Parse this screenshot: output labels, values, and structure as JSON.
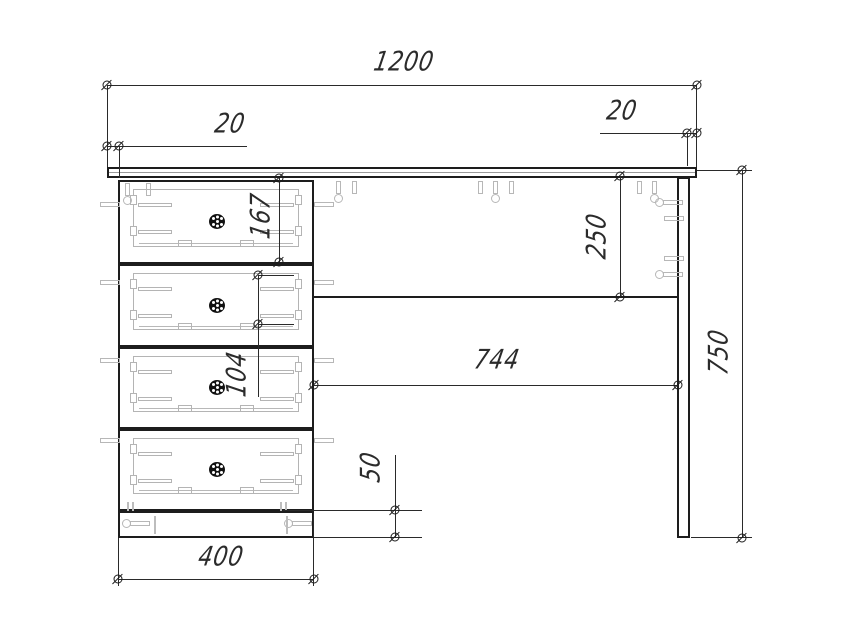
{
  "drawing_title": "desk-front-elevation",
  "dimensions": {
    "top_width": "1200",
    "left_overhang": "20",
    "right_overhang": "20",
    "drawer_front_height": "167",
    "apron_height": "250",
    "slide_spacing": "104",
    "knee_space_width": "744",
    "total_height": "750",
    "plinth_height": "50",
    "pedestal_width": "400"
  },
  "colors": {
    "line": "#1d1d1d",
    "dimension": "#2a2a2a",
    "hardware": "#b7b7b7",
    "text": "#2b2b2b",
    "knob": "#111111",
    "background": "#ffffff"
  }
}
